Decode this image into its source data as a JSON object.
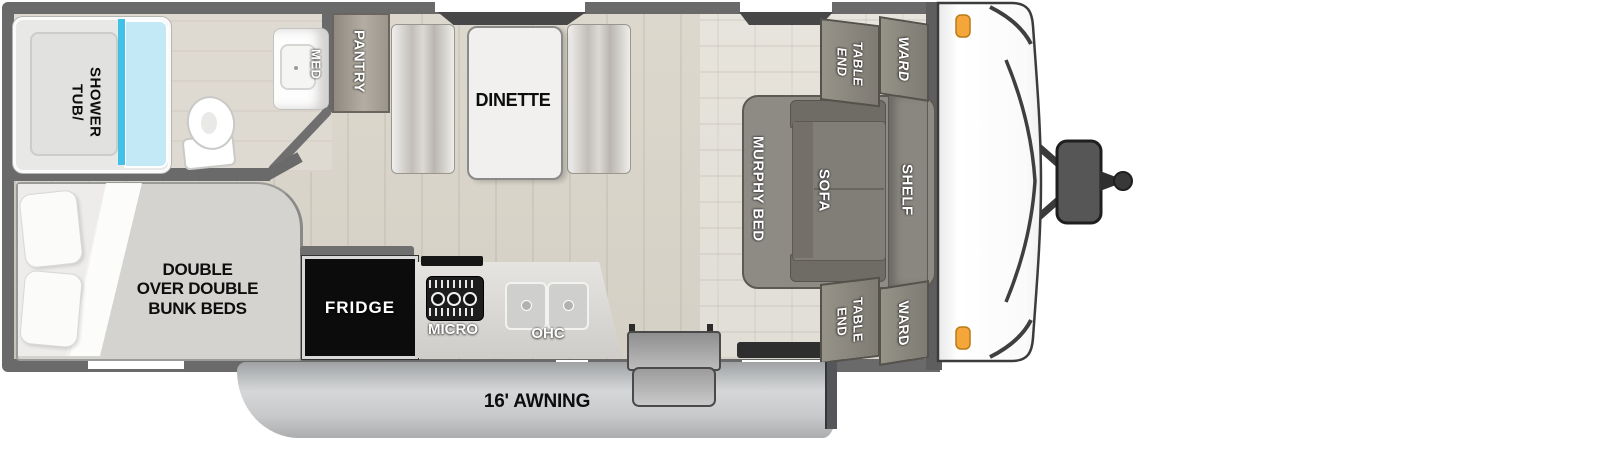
{
  "labels": {
    "bathroom": {
      "tub_shower": [
        "TUB/",
        "SHOWER"
      ],
      "med": "MED"
    },
    "kitchen": {
      "pantry": "PANTRY",
      "fridge": "FRIDGE",
      "micro": "MICRO",
      "ohc": "OHC"
    },
    "dinette": {
      "label": "DINETTE"
    },
    "living": {
      "murphy_bed": "MURPHY BED",
      "sofa": "SOFA",
      "shelf": "SHELF",
      "end_table": [
        "END",
        "TABLE"
      ],
      "ward": "WARD"
    },
    "bunk": {
      "lines": [
        "DOUBLE",
        "OVER DOUBLE",
        "BUNK BEDS"
      ]
    },
    "exterior": {
      "awning": "16' AWNING"
    }
  },
  "colors": {
    "wall": "#6a6a6a",
    "floor": "#d8d4c9",
    "shower_glass": "#3fc1e8",
    "marker_light": "#f4a63b",
    "fridge": "#0c0c0c",
    "cabinet": "#8b8882"
  }
}
